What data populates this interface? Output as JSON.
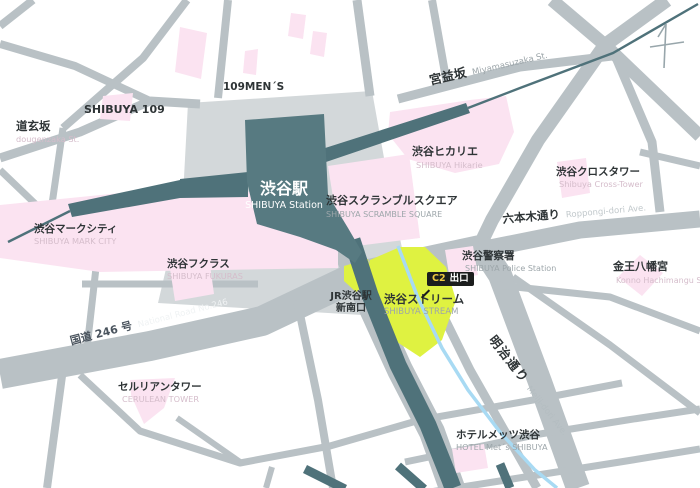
{
  "map": {
    "colors": {
      "road": "#b9c1c5",
      "plaza": "#d3d8da",
      "building_pink": "#fbe3f1",
      "rail_dark": "#4f727a",
      "station_fill": "#577a81",
      "stream_yellow": "#dff241",
      "river_blue": "#a8daf3",
      "badge_bg": "#1b1d1d",
      "badge_code": "#edc83f",
      "label_dark": "#2e3436",
      "sub_gray": "#9da6aa",
      "sub_pink": "#d5bdcb"
    },
    "labels": {
      "shibuya_109": {
        "ja": "SHIBUYA 109"
      },
      "men_109": {
        "ja": "109MEN´S"
      },
      "dougenzaka": {
        "ja": "道玄坂",
        "en": "dougenzaka St."
      },
      "station": {
        "ja": "渋谷駅",
        "en": "SHIBUYA Station"
      },
      "mark_city": {
        "ja": "渋谷マークシティ",
        "en": "SHIBUYA MARK CITY"
      },
      "scramble_square": {
        "ja": "渋谷スクランブルスクエア",
        "en": "SHIBUYA SCRAMBLE SQUARE"
      },
      "hikarie": {
        "ja": "渋谷ヒカリエ",
        "en": "SHIBUYA Hikarie"
      },
      "cross_tower": {
        "ja": "渋谷クロスタワー",
        "en": "Shibuya Cross-Tower"
      },
      "miyamasuzaka": {
        "ja": "宮益坂",
        "en": "Miyamasuzaka St."
      },
      "roppongi_dori": {
        "ja": "六本木通り",
        "en": "Roppongi-dori Ave."
      },
      "route_246": {
        "ja": "国道 246 号",
        "en": "National Road No.246"
      },
      "fukuras": {
        "ja": "渋谷フクラス",
        "en": "SHIBUYA FUKURAS"
      },
      "cerulean": {
        "ja": "セルリアンタワー",
        "en": "CERULEAN TOWER"
      },
      "jr_new_south_gate": {
        "line1": "JR渋谷駅",
        "line2": "新南口"
      },
      "stream": {
        "ja": "渋谷ストリーム",
        "en": "SHIBUYA STREAM"
      },
      "c2_exit": {
        "code": "C2",
        "label": "出口"
      },
      "police": {
        "ja": "渋谷警察署",
        "en": "SHIBUYA Police Station"
      },
      "konno_shrine": {
        "ja": "金王八幡宮",
        "en": "Konno Hachimangu Shrine"
      },
      "meiji_dori": {
        "ja": "明治通り",
        "en": "Meiji-dori Ave."
      },
      "hotel_mets": {
        "ja": "ホテルメッツ渋谷",
        "en": "HOTEL Met´s SHIBUYA"
      }
    }
  }
}
